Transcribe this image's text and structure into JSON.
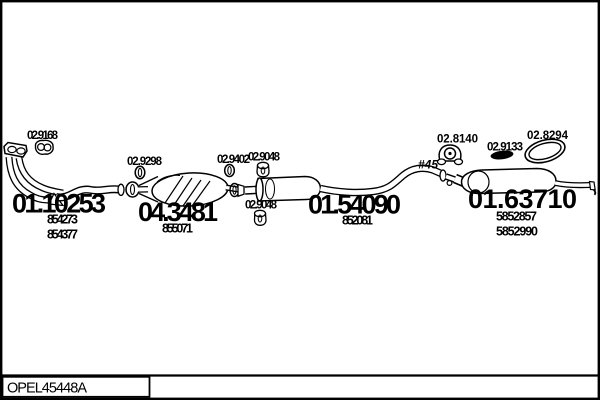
{
  "colors": {
    "ink": "#000000",
    "paper": "#ffffff"
  },
  "footer": {
    "drawing_code": "OPEL45448A"
  },
  "parts": {
    "front_pipe": {
      "code": "01.10253",
      "oe_refs": [
        "854273",
        "854377"
      ]
    },
    "catalytic_converter": {
      "code": "04.3481",
      "oe_refs": [
        "855071"
      ]
    },
    "centre_silencer": {
      "code": "01.54090",
      "oe_refs": [
        "852081"
      ]
    },
    "rear_silencer": {
      "code": "01.63710",
      "oe_refs": [
        "5852857",
        "5852990"
      ]
    },
    "front_clamp": {
      "code": "02.9168"
    },
    "joint_ring": {
      "code": "02.9298"
    },
    "outlet_ring": {
      "code": "02.9402"
    },
    "hanger_upper": {
      "code": "02.9048"
    },
    "hanger_lower": {
      "code": "02.9048"
    },
    "rear_bracket": {
      "code": "02.8140"
    },
    "rear_gasket": {
      "code": "02.9133"
    },
    "rear_clamp_ring": {
      "code": "02.8294"
    },
    "pipe_diameter_note": {
      "text": "#45"
    }
  }
}
